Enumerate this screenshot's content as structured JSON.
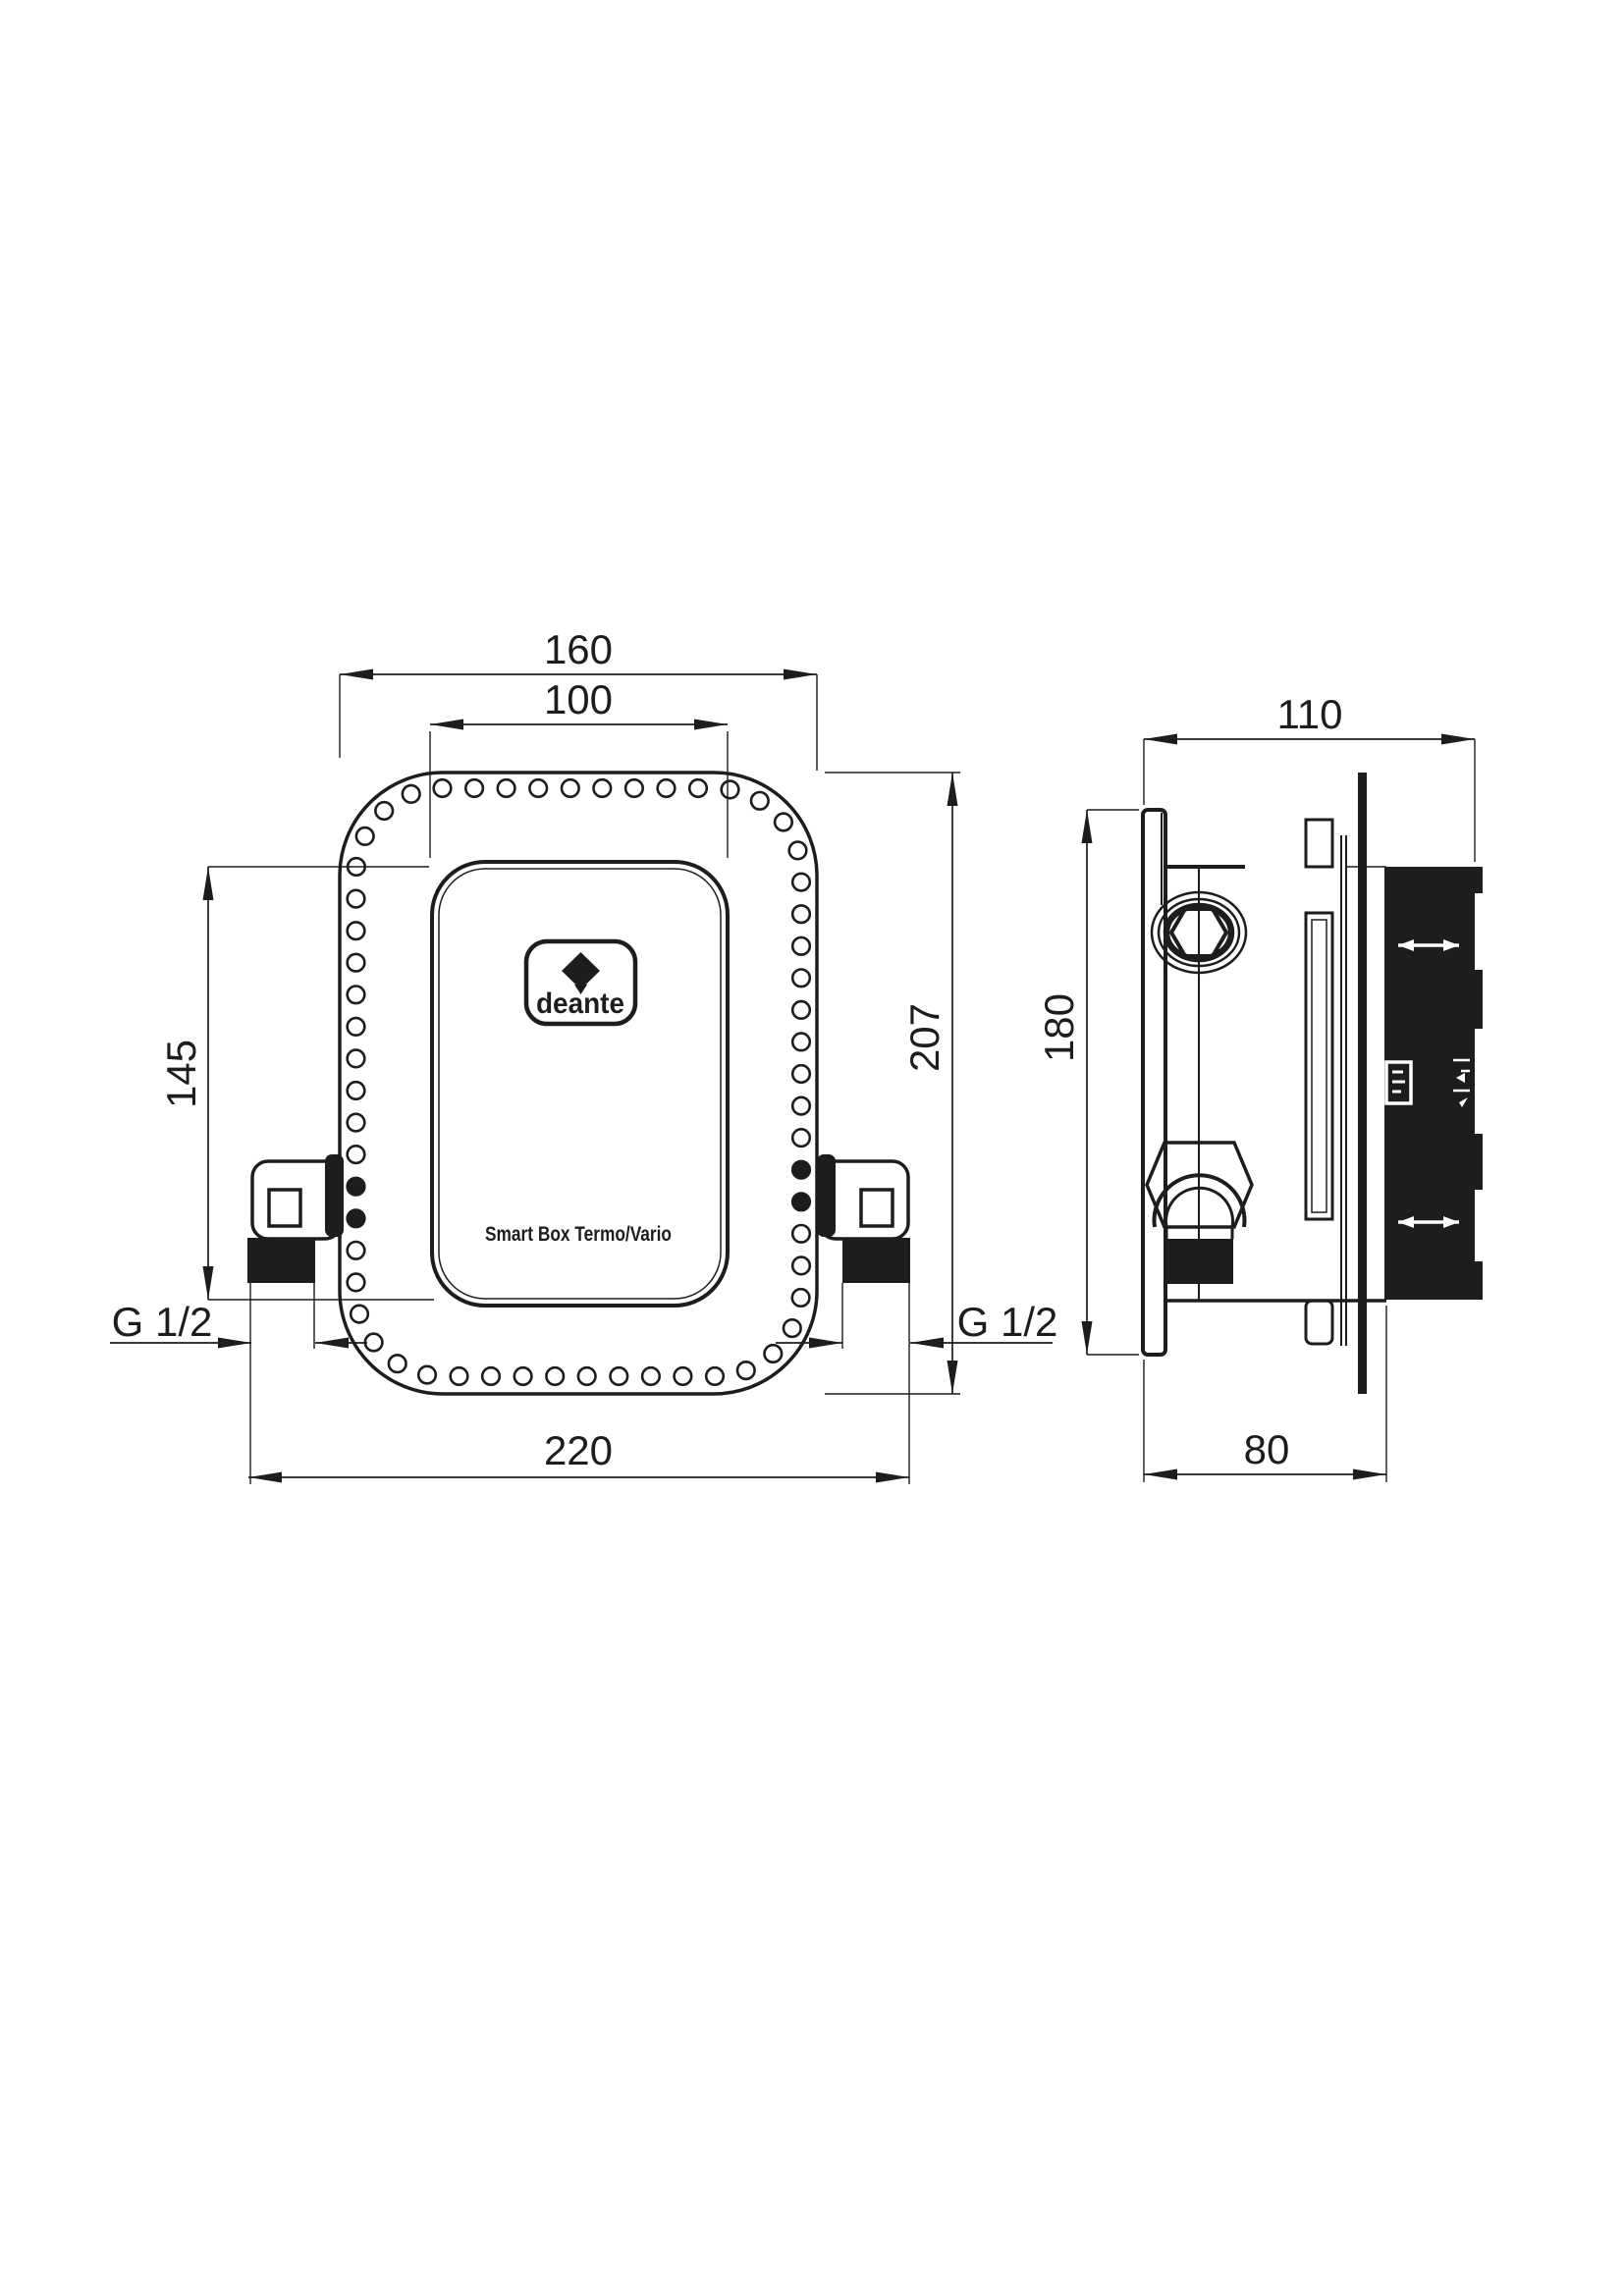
{
  "drawing_title": "Smart Box Termo/Vario installation drawing",
  "brand": "deante",
  "product_label": "Smart Box Termo/Vario",
  "front_view": {
    "overall_width": "160",
    "cover_width": "100",
    "cover_height": "145",
    "overall_height": "207",
    "connection_span": "220",
    "thread_left": "G 1/2",
    "thread_right": "G 1/2"
  },
  "side_view": {
    "overall_depth": "110",
    "plate_height": "180",
    "box_depth": "80"
  },
  "hole_ring": {
    "count": 60,
    "radius": 8.8
  },
  "colors": {
    "line": "#1d1d1b",
    "background": "#ffffff"
  }
}
